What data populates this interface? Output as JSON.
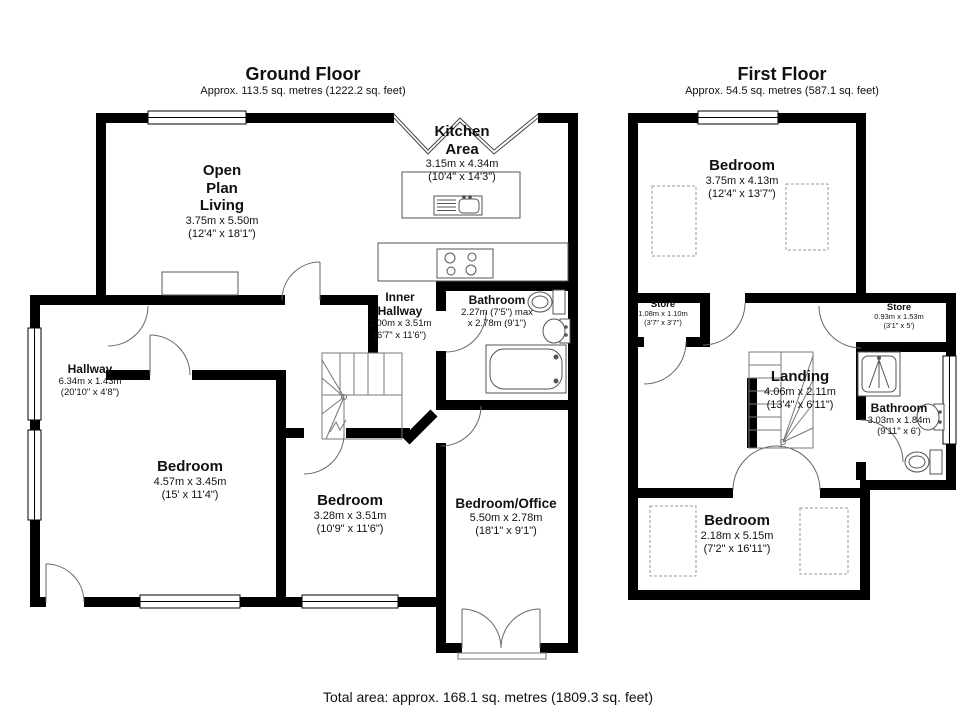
{
  "colors": {
    "wall": "#000000",
    "fixture_line": "#555555",
    "text": "#111111"
  },
  "ground_floor": {
    "title": "Ground Floor",
    "subtitle": "Approx. 113.5 sq. metres (1222.2 sq. feet)",
    "rooms": {
      "open_plan_living": {
        "line1": "Open",
        "line2": "Plan",
        "line3": "Living",
        "dims_m": "3.75m x 5.50m",
        "dims_ft": "(12'4\" x 18'1\")"
      },
      "kitchen_area": {
        "line1": "Kitchen",
        "line2": "Area",
        "dims_m": "3.15m x 4.34m",
        "dims_ft": "(10'4\" x 14'3\")"
      },
      "inner_hallway": {
        "line1": "Inner",
        "line2": "Hallway",
        "dims_m": "2.00m x 3.51m",
        "dims_ft": "(6'7\" x 11'6\")"
      },
      "bathroom": {
        "name": "Bathroom",
        "dims_m": "2.27m (7'5\") max",
        "dims_ft": "x 2.78m (9'1\")"
      },
      "hallway": {
        "name": "Hallway",
        "dims_m": "6.34m x 1.43m",
        "dims_ft": "(20'10\" x 4'8\")"
      },
      "bedroom1": {
        "name": "Bedroom",
        "dims_m": "4.57m x 3.45m",
        "dims_ft": "(15' x 11'4\")"
      },
      "bedroom2": {
        "name": "Bedroom",
        "dims_m": "3.28m x 3.51m",
        "dims_ft": "(10'9\" x 11'6\")"
      },
      "bedroom_office": {
        "name": "Bedroom/Office",
        "dims_m": "5.50m x 2.78m",
        "dims_ft": "(18'1\" x 9'1\")"
      }
    }
  },
  "first_floor": {
    "title": "First Floor",
    "subtitle": "Approx. 54.5 sq. metres (587.1 sq. feet)",
    "rooms": {
      "bedroom_front": {
        "name": "Bedroom",
        "dims_m": "3.75m x 4.13m",
        "dims_ft": "(12'4\" x 13'7\")"
      },
      "store_left": {
        "name": "Store",
        "dims_m": "1.08m x 1.10m",
        "dims_ft": "(3'7\" x 3'7\")"
      },
      "store_right": {
        "name": "Store",
        "dims_m": "0.93m x 1.53m",
        "dims_ft": "(3'1\" x 5')"
      },
      "landing": {
        "name": "Landing",
        "dims_m": "4.06m x 2.11m",
        "dims_ft": "(13'4\" x 6'11\")"
      },
      "bathroom": {
        "name": "Bathroom",
        "dims_m": "3.03m x 1.84m",
        "dims_ft": "(9'11\" x 6')"
      },
      "bedroom_back": {
        "name": "Bedroom",
        "dims_m": "2.18m x 5.15m",
        "dims_ft": "(7'2\" x 16'11\")"
      }
    }
  },
  "footer": {
    "total_area": "Total area: approx. 168.1 sq. metres (1809.3 sq. feet)"
  }
}
